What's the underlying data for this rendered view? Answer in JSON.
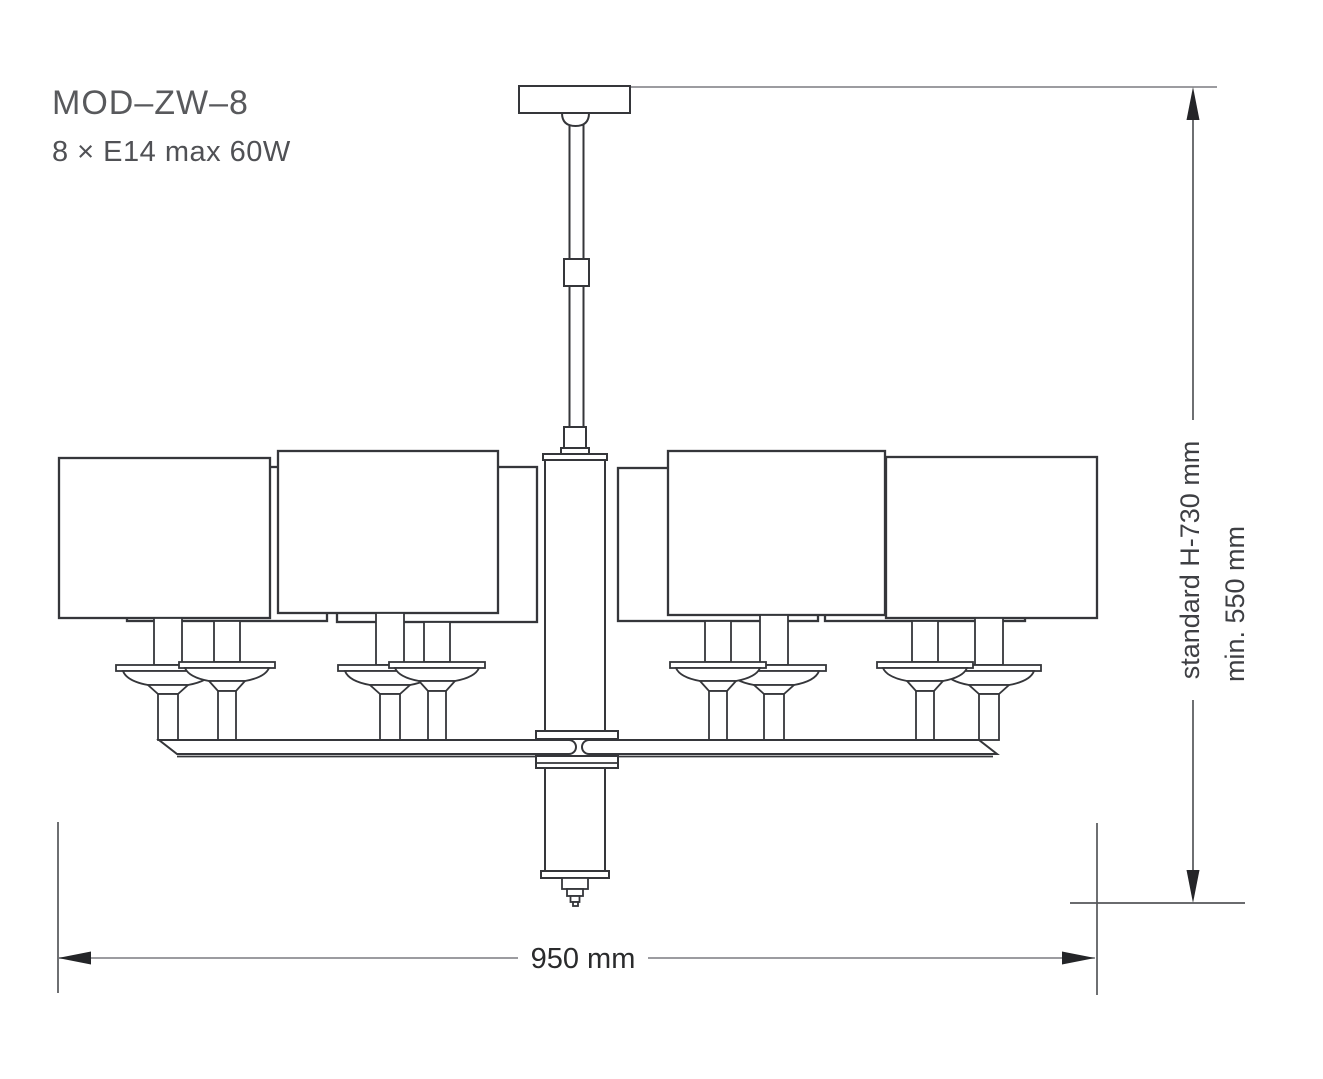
{
  "labels": {
    "model": "MOD–ZW–8",
    "lamping": "8 × E14 max 60W",
    "dim_height_standard": "standard H-730 mm",
    "dim_height_min": "min. 550 mm",
    "dim_width": "950 mm"
  },
  "colors": {
    "background": "#ffffff",
    "line": "#35363a",
    "dimension_line": "#55565a",
    "extension_line": "#7b7c80",
    "arrow": "#242528",
    "title_text": "#58595c",
    "label_text": "#3e3f43"
  }
}
